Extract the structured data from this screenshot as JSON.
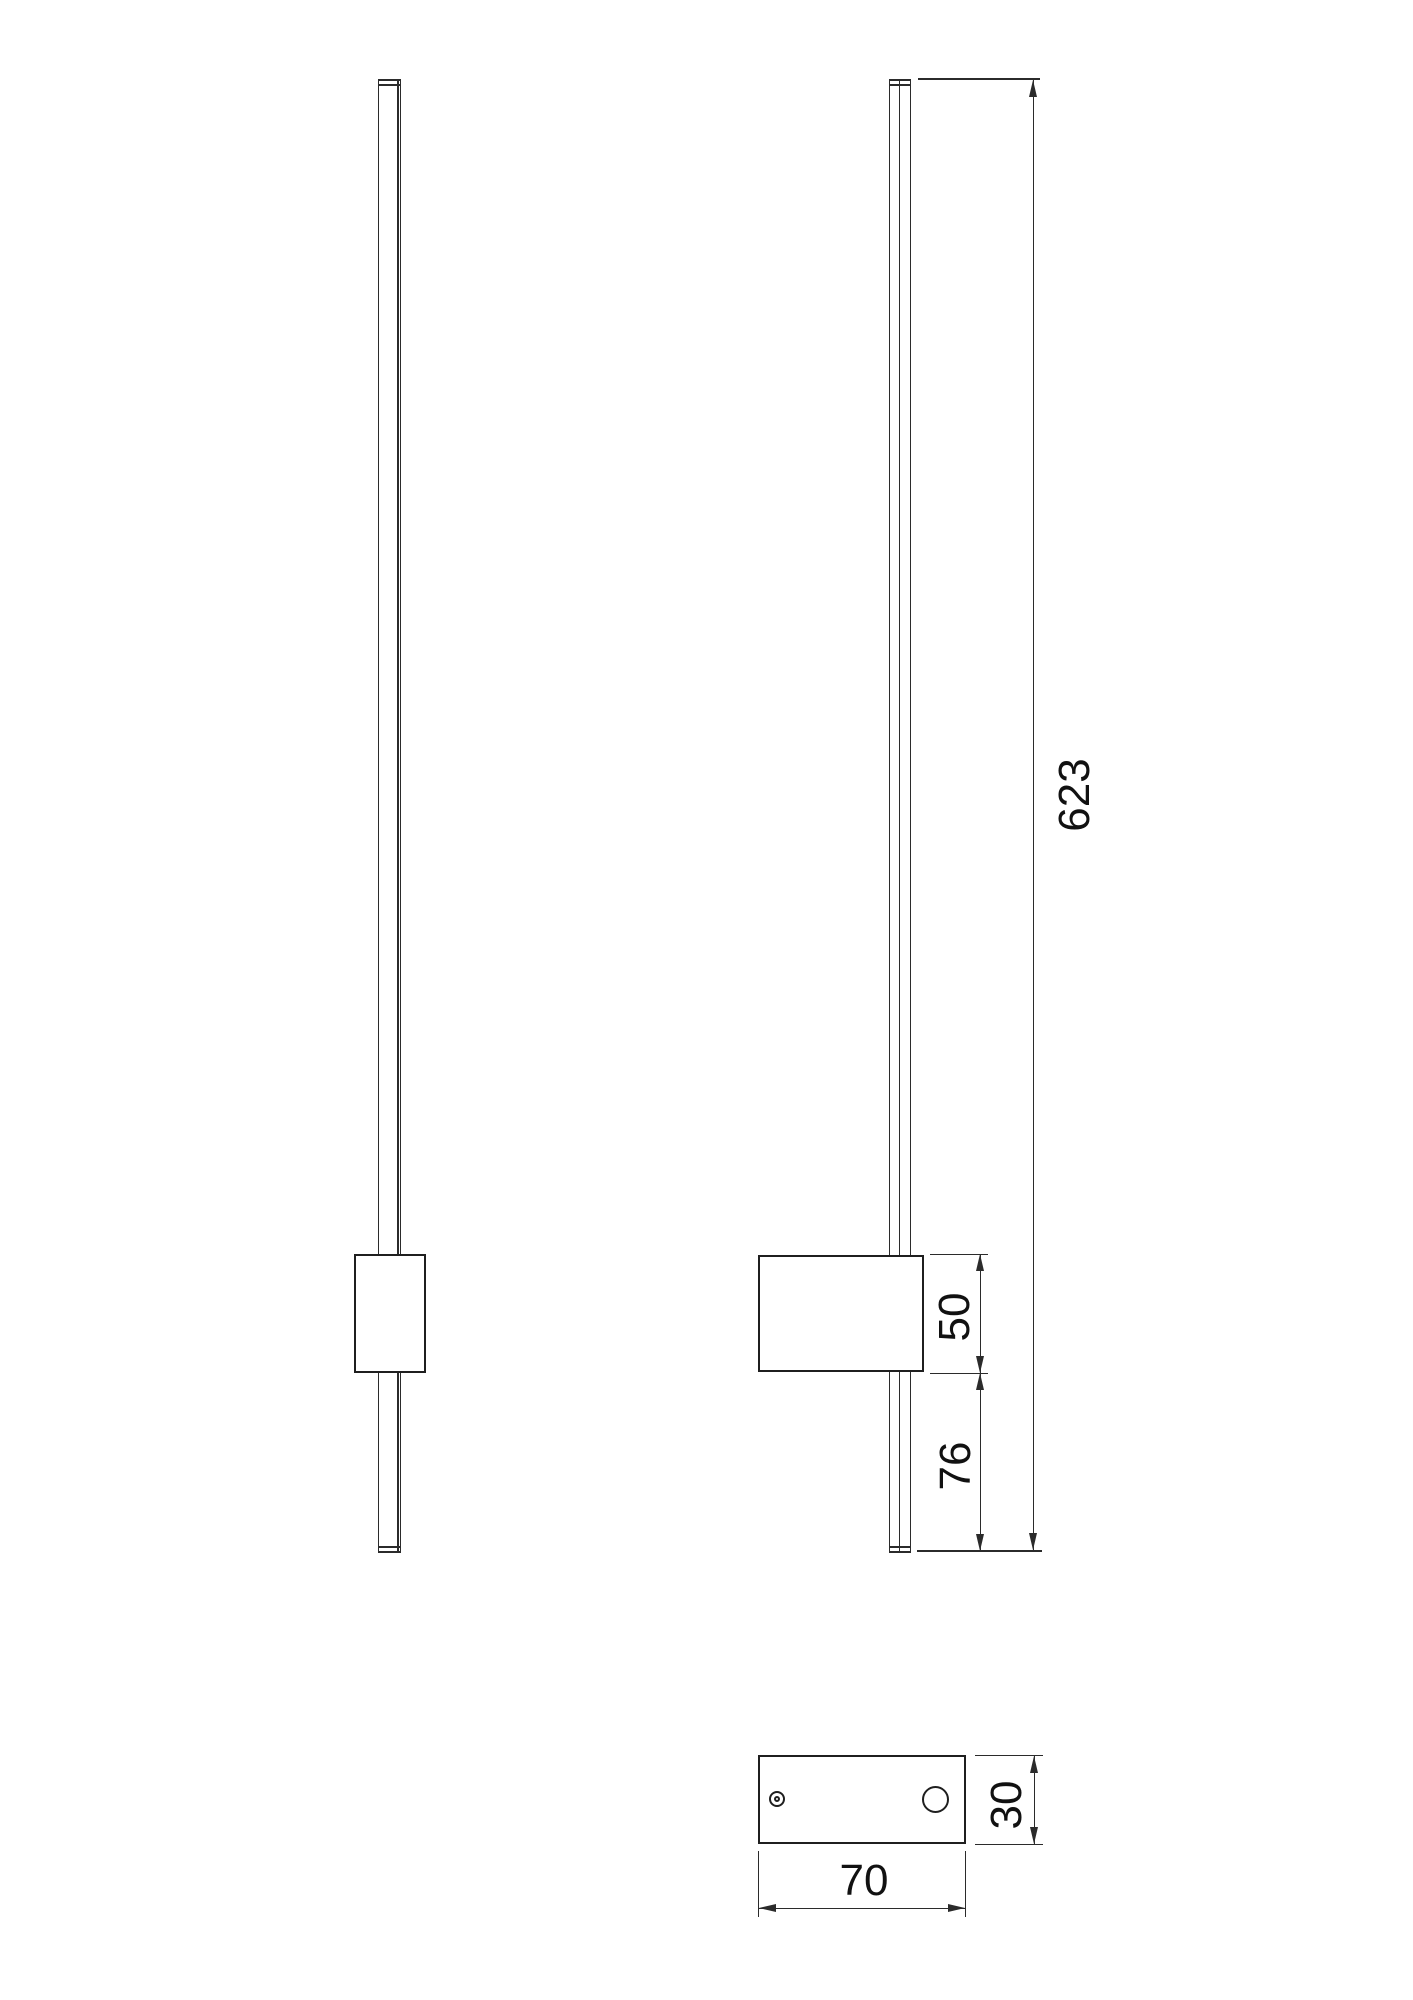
{
  "colors": {
    "background": "#ffffff",
    "line": "#2b2b2b",
    "text": "#111111"
  },
  "dimensions": {
    "total_height": "623",
    "driver_box_height": "50",
    "box_to_bar_end": "76",
    "plate_length": "70",
    "plate_width": "30"
  }
}
